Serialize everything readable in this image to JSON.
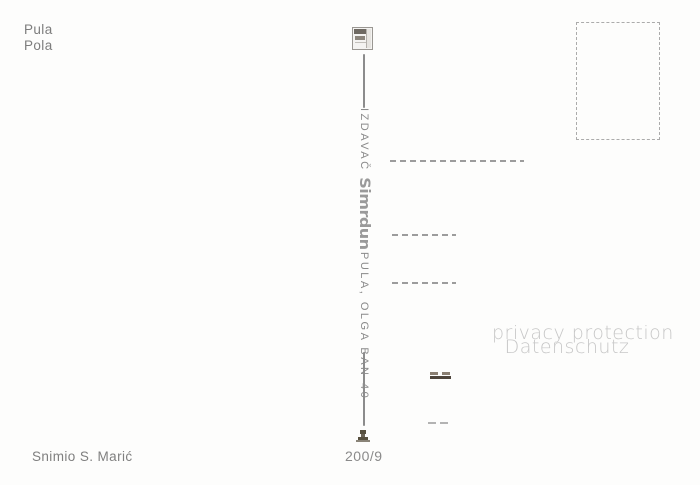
{
  "postcard": {
    "caption": {
      "line1": "Pula",
      "line2": "Pola"
    },
    "publisher": {
      "prefix": "IZDAVAČ",
      "logo_text": "Simrdun",
      "address": "PULA, OLGA BAN 40"
    },
    "photo_credit": "Snimio S. Marić",
    "series_number": "200/9",
    "watermark": {
      "line1": "privacy protection",
      "line2": "Datenschutz"
    }
  },
  "icons": {
    "publisher_logo": "publisher-logo-icon",
    "printer_mark": "printer-mark-icon"
  },
  "colors": {
    "background": "#fdfdfc",
    "text_gray": "#7d7d7d",
    "dash_gray": "#9c9c9c",
    "watermark_gray": "#c7c7c7",
    "dark_mark": "#4e453c",
    "stamp_border": "#ababab"
  }
}
